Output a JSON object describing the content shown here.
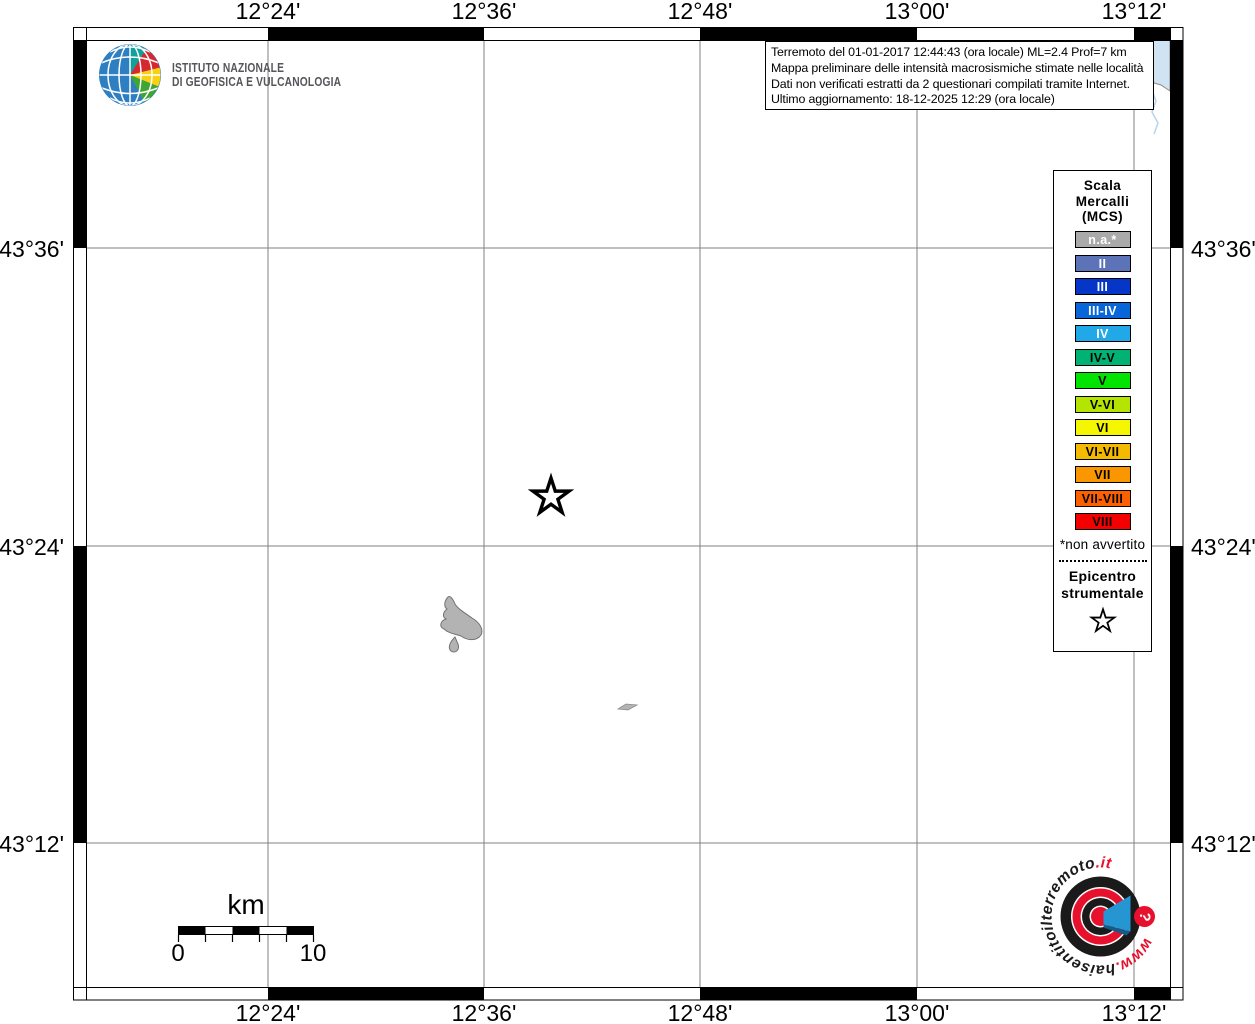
{
  "branding": {
    "icon": "ingv-globe-icon",
    "line1": "ISTITUTO NAZIONALE",
    "line2": "DI GEOFISICA E VULCANOLOGIA"
  },
  "info_box": {
    "lines": [
      "Terremoto del 01-01-2017 12:44:43 (ora locale) ML=2.4 Prof=7 km",
      "Mappa preliminare delle intensità macrosismiche stimate nelle località",
      "Dati non verificati estratti da 2 questionari compilati tramite Internet.",
      "Ultimo aggiornamento: 18-12-2025 12:29 (ora locale)"
    ]
  },
  "axes": {
    "top": [
      "12°24'",
      "12°36'",
      "12°48'",
      "13°00'",
      "13°12'"
    ],
    "bottom": [
      "12°24'",
      "12°36'",
      "12°48'",
      "13°00'",
      "13°12'"
    ],
    "left": [
      "43°36'",
      "43°24'",
      "43°12'"
    ],
    "right": [
      "43°36'",
      "43°24'",
      "43°12'"
    ]
  },
  "legend": {
    "title_lines": [
      "Scala",
      "Mercalli",
      "(MCS)"
    ],
    "items": [
      {
        "label": "n.a.*",
        "color": "#aaaaaa",
        "text_color": "#ffffff"
      },
      {
        "label": "II",
        "color": "#5c73b8",
        "text_color": "#ffffff"
      },
      {
        "label": "III",
        "color": "#0536c8",
        "text_color": "#ffffff"
      },
      {
        "label": "III-IV",
        "color": "#0866d8",
        "text_color": "#ffffff"
      },
      {
        "label": "IV",
        "color": "#20a8e8",
        "text_color": "#ffffff"
      },
      {
        "label": "IV-V",
        "color": "#00b274",
        "text_color": "#000000"
      },
      {
        "label": "V",
        "color": "#00e400",
        "text_color": "#000000"
      },
      {
        "label": "V-VI",
        "color": "#b4e400",
        "text_color": "#000000"
      },
      {
        "label": "VI",
        "color": "#f6f600",
        "text_color": "#000000"
      },
      {
        "label": "VI-VII",
        "color": "#f4ba00",
        "text_color": "#000000"
      },
      {
        "label": "VII",
        "color": "#fa9600",
        "text_color": "#000000"
      },
      {
        "label": "VII-VIII",
        "color": "#fc6000",
        "text_color": "#000000"
      },
      {
        "label": "VIII",
        "color": "#f50000",
        "text_color": "#000000"
      }
    ],
    "footnote": "*non avvertito",
    "epicenter_lines": [
      "Epicentro",
      "strumentale"
    ],
    "epicenter_icon": "star-outline"
  },
  "scale_bar": {
    "unit": "km",
    "start_label": "0",
    "end_label": "10"
  },
  "watermark": {
    "icon": "bullseye-megaphone",
    "url_prefix": "www.",
    "url_mid": "haisentitoilterremoto",
    "url_suffix": ".it",
    "question_mark": "?"
  },
  "map": {
    "epicenter_icon": "star-outline",
    "colors": {
      "grid": "#828282",
      "sea": "#cfe3f3",
      "river": "#b7d4ec",
      "lake_fill": "#b3b3b3",
      "lake_stroke": "#737373",
      "watermark_red": "#e8112d",
      "watermark_blue": "#2596d1"
    }
  }
}
